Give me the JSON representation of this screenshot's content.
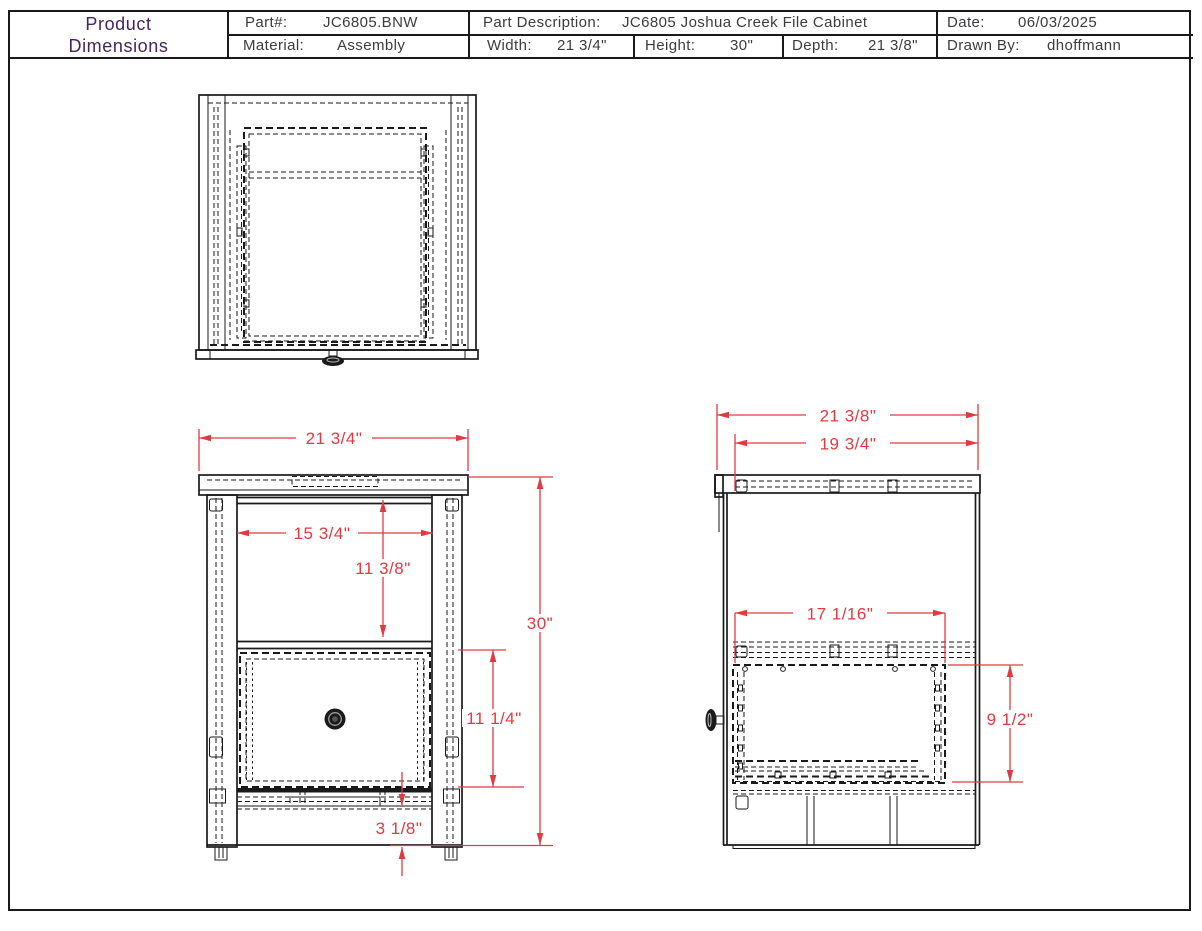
{
  "title_block": {
    "title_line1": "Product",
    "title_line2": "Dimensions",
    "part_label": "Part#:",
    "part_value": "JC6805.BNW",
    "desc_label": "Part Description:",
    "desc_value": "JC6805 Joshua Creek File Cabinet",
    "date_label": "Date:",
    "date_value": "06/03/2025",
    "material_label": "Material:",
    "material_value": "Assembly",
    "width_label": "Width:",
    "width_value": "21 3/4\"",
    "height_label": "Height:",
    "height_value": "30\"",
    "depth_label": "Depth:",
    "depth_value": "21 3/8\"",
    "drawnby_label": "Drawn By:",
    "drawnby_value": "dhoffmann"
  },
  "views": {
    "front": {
      "dims": {
        "overall_width": "21 3/4\"",
        "opening_width": "15 3/4\"",
        "opening_height": "11 3/8\"",
        "overall_height": "30\"",
        "drawer_height": "11 1/4\"",
        "base_height": "3 1/8\""
      }
    },
    "side": {
      "dims": {
        "overall_depth": "21 3/8\"",
        "top_depth": "19 3/4\"",
        "drawer_depth": "17 1/16\"",
        "drawer_side_height": "9 1/2\""
      }
    }
  },
  "colors": {
    "dimension_red": "#e23a41",
    "title_purple": "#44265e",
    "line_black": "#1a1a1a",
    "text_gray": "#3e3b40"
  }
}
